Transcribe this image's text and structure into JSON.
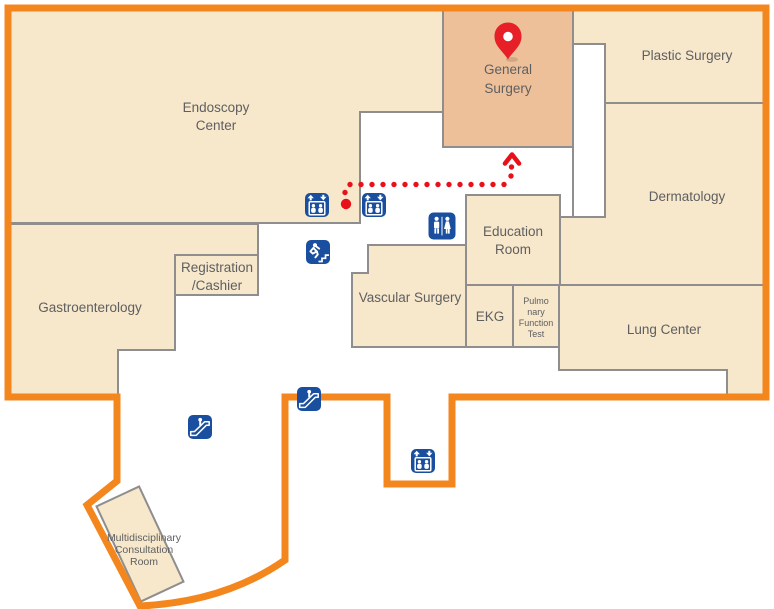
{
  "map": {
    "kind": "hospital floor map",
    "highlighted_room": "General Surgery"
  },
  "colors": {
    "outline_orange": "#f3861d",
    "room_fill": "#f7e7cb",
    "highlight_fill": "#edc09a",
    "void_fill": "#ffffff",
    "wall_gray": "#8e8e8e",
    "label_gray": "#5e5f61",
    "icon_blue": "#1a4e9e",
    "route_red": "#e8111a",
    "marker_red": "#e71f26"
  },
  "rooms": {
    "endoscopy_center": {
      "line1": "Endoscopy",
      "line2": "Center"
    },
    "general_surgery": {
      "line1": "General",
      "line2": "Surgery"
    },
    "plastic_surgery": {
      "line1": "Plastic Surgery"
    },
    "dermatology": {
      "line1": "Dermatology"
    },
    "gastroenterology": {
      "line1": "Gastroenterology"
    },
    "registration_cashier": {
      "line1": "Registration",
      "line2": "/Cashier"
    },
    "vascular_surgery": {
      "line1": "Vascular Surgery"
    },
    "education_room": {
      "line1": "Education",
      "line2": "Room"
    },
    "ekg": {
      "line1": "EKG"
    },
    "pulmonary_function_test": {
      "line1": "Pulmo",
      "line2": "nary",
      "line3": "Function",
      "line4": "Test"
    },
    "lung_center": {
      "line1": "Lung Center"
    },
    "multidisciplinary_consultation_room": {
      "line1": "Multidisciplinary",
      "line2": "Consultation",
      "line3": "Room"
    }
  },
  "marker": {
    "type": "location-pin",
    "on_room": "General Surgery"
  },
  "facility_icons": [
    {
      "id": "elevator-upper-1",
      "type": "elevator"
    },
    {
      "id": "elevator-upper-2",
      "type": "elevator"
    },
    {
      "id": "restroom",
      "type": "restroom"
    },
    {
      "id": "emergency-exit",
      "type": "emergency-exit-stairs"
    },
    {
      "id": "escalator-corridor",
      "type": "escalator"
    },
    {
      "id": "escalator-border",
      "type": "escalator"
    },
    {
      "id": "elevator-lower",
      "type": "elevator"
    }
  ]
}
